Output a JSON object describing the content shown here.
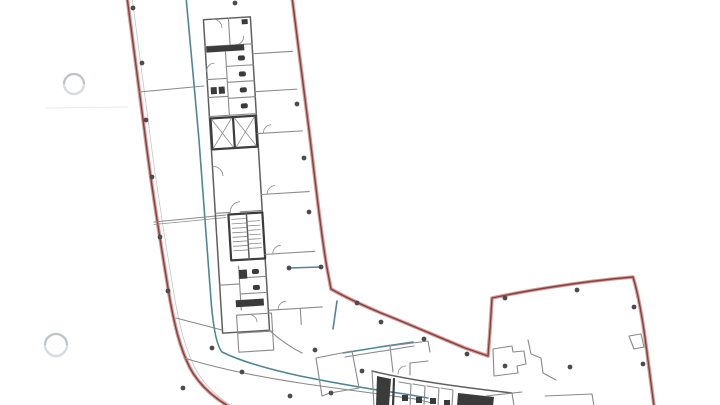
{
  "document": {
    "kind": "scanned architectural floor plan",
    "page_background": "#ffffff",
    "visible_text": ""
  },
  "colors": {
    "red": "#8e3c3c",
    "red_halo": "#cfa09c",
    "teal": "#4e8696",
    "wall": "#8a8a8a",
    "wall_mid": "#5f5f5f",
    "wall_dark": "#3b3b3b",
    "column": "#4c4c4c",
    "punch": "#d7dbde",
    "punch_dark": "#bcc2c7",
    "crease": "#ededed"
  },
  "features": {
    "site_boundary": "double red line",
    "demise_line": "teal polyline",
    "service_core": "wc cubicles, two lift shafts, staircase",
    "secondary_core": "cropped at bottom edge",
    "hole_punches": 2,
    "column_dots": 29
  },
  "hole_punches": [
    {
      "cx": 74,
      "cy": 84,
      "r": 10
    },
    {
      "cx": 56,
      "cy": 345,
      "r": 11
    }
  ],
  "columns": [
    [
      133,
      8
    ],
    [
      235,
      3
    ],
    [
      142,
      63
    ],
    [
      146,
      120
    ],
    [
      152,
      177
    ],
    [
      160,
      237
    ],
    [
      168,
      291
    ],
    [
      297,
      104
    ],
    [
      304,
      158
    ],
    [
      309,
      212
    ],
    [
      289,
      268
    ],
    [
      321,
      267
    ],
    [
      357,
      303
    ],
    [
      381,
      322
    ],
    [
      424,
      339
    ],
    [
      467,
      354
    ],
    [
      212,
      348
    ],
    [
      242,
      372
    ],
    [
      183,
      388
    ],
    [
      290,
      396
    ],
    [
      331,
      393
    ],
    [
      315,
      350
    ],
    [
      362,
      371
    ],
    [
      505,
      298
    ],
    [
      577,
      290
    ],
    [
      634,
      307
    ],
    [
      505,
      366
    ],
    [
      570,
      367
    ],
    [
      643,
      364
    ]
  ]
}
